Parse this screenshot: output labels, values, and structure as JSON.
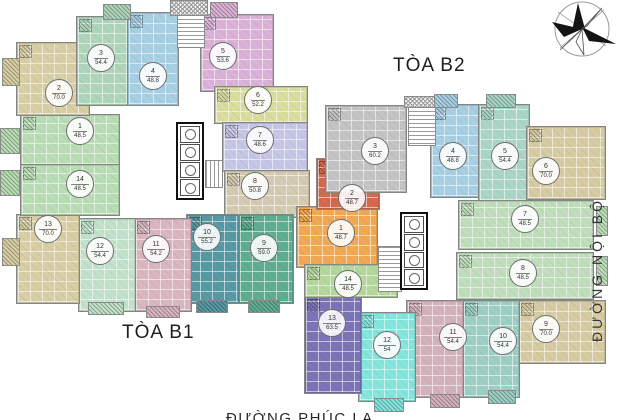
{
  "labels": {
    "tower_b1": "TÒA B1",
    "tower_b2": "TÒA B2",
    "road_right": "ĐƯỜNG NỘI BỘ",
    "road_bottom": "ĐƯỜNG PHÚC LA"
  },
  "towers": [
    {
      "id": "B1",
      "units": [
        {
          "no": "1",
          "area": "48.5",
          "color": "#b9ddb4",
          "x": 20,
          "y": 114,
          "w": 98,
          "h": 50,
          "lx": 79,
          "ly": 130
        },
        {
          "no": "2",
          "area": "70.0",
          "color": "#d9cfa4",
          "x": 16,
          "y": 42,
          "w": 72,
          "h": 72,
          "lx": 58,
          "ly": 92
        },
        {
          "no": "3",
          "area": "54.4",
          "color": "#afd6ba",
          "x": 76,
          "y": 16,
          "w": 52,
          "h": 88,
          "lx": 100,
          "ly": 57
        },
        {
          "no": "4",
          "area": "48.8",
          "color": "#a8d0e4",
          "x": 127,
          "y": 12,
          "w": 50,
          "h": 92,
          "lx": 152,
          "ly": 75
        },
        {
          "no": "5",
          "area": "53.6",
          "color": "#dcb2d8",
          "x": 200,
          "y": 14,
          "w": 72,
          "h": 76,
          "lx": 222,
          "ly": 55
        },
        {
          "no": "6",
          "area": "52.2",
          "color": "#d9dd9e",
          "x": 214,
          "y": 86,
          "w": 92,
          "h": 36,
          "lx": 257,
          "ly": 99
        },
        {
          "no": "7",
          "area": "48.6",
          "color": "#c6c6e6",
          "x": 222,
          "y": 122,
          "w": 84,
          "h": 48,
          "lx": 259,
          "ly": 139
        },
        {
          "no": "8",
          "area": "50.8",
          "color": "#d5cbb2",
          "x": 224,
          "y": 170,
          "w": 84,
          "h": 46,
          "lx": 254,
          "ly": 185
        },
        {
          "no": "9",
          "area": "59.0",
          "color": "#5fae91",
          "x": 238,
          "y": 214,
          "w": 54,
          "h": 88,
          "lx": 263,
          "ly": 247
        },
        {
          "no": "10",
          "area": "55.2",
          "color": "#569aa4",
          "x": 186,
          "y": 214,
          "w": 52,
          "h": 88,
          "lx": 206,
          "ly": 236
        },
        {
          "no": "11",
          "area": "54.2",
          "color": "#d9b6c0",
          "x": 134,
          "y": 218,
          "w": 56,
          "h": 92,
          "lx": 155,
          "ly": 248
        },
        {
          "no": "12",
          "area": "54.4",
          "color": "#c3e2cb",
          "x": 78,
          "y": 218,
          "w": 56,
          "h": 92,
          "lx": 99,
          "ly": 250
        },
        {
          "no": "13",
          "area": "70.0",
          "color": "#d9cfa4",
          "x": 16,
          "y": 214,
          "w": 62,
          "h": 88,
          "lx": 47,
          "ly": 228
        },
        {
          "no": "14",
          "area": "48.5",
          "color": "#b9ddb4",
          "x": 20,
          "y": 164,
          "w": 98,
          "h": 50,
          "lx": 79,
          "ly": 183
        }
      ]
    },
    {
      "id": "B2",
      "units": [
        {
          "no": "1",
          "area": "48.7",
          "color": "#f2a953",
          "x": 296,
          "y": 206,
          "w": 80,
          "h": 60,
          "lx": 340,
          "ly": 232
        },
        {
          "no": "2",
          "area": "48.7",
          "color": "#d4694e",
          "x": 316,
          "y": 158,
          "w": 62,
          "h": 50,
          "lx": 351,
          "ly": 197
        },
        {
          "no": "3",
          "area": "60.2",
          "color": "#c4c4c4",
          "x": 325,
          "y": 105,
          "w": 80,
          "h": 86,
          "lx": 374,
          "ly": 150
        },
        {
          "no": "4",
          "area": "48.8",
          "color": "#a8d0e4",
          "x": 430,
          "y": 104,
          "w": 50,
          "h": 92,
          "lx": 452,
          "ly": 155
        },
        {
          "no": "5",
          "area": "54.4",
          "color": "#abd6c6",
          "x": 478,
          "y": 104,
          "w": 50,
          "h": 96,
          "lx": 504,
          "ly": 155
        },
        {
          "no": "6",
          "area": "70.0",
          "color": "#d6cba2",
          "x": 526,
          "y": 126,
          "w": 78,
          "h": 72,
          "lx": 545,
          "ly": 170
        },
        {
          "no": "7",
          "area": "48.5",
          "color": "#c0debc",
          "x": 458,
          "y": 200,
          "w": 134,
          "h": 48,
          "lx": 524,
          "ly": 218
        },
        {
          "no": "8",
          "area": "48.5",
          "color": "#c0debc",
          "x": 456,
          "y": 252,
          "w": 136,
          "h": 46,
          "lx": 522,
          "ly": 272
        },
        {
          "no": "9",
          "area": "70.0",
          "color": "#d6cba2",
          "x": 518,
          "y": 300,
          "w": 86,
          "h": 62,
          "lx": 545,
          "ly": 328
        },
        {
          "no": "10",
          "area": "54.4",
          "color": "#9ecfc4",
          "x": 462,
          "y": 300,
          "w": 56,
          "h": 96,
          "lx": 502,
          "ly": 340
        },
        {
          "no": "11",
          "area": "54.4",
          "color": "#d4b2bc",
          "x": 406,
          "y": 300,
          "w": 56,
          "h": 96,
          "lx": 452,
          "ly": 336
        },
        {
          "no": "12",
          "area": "54",
          "color": "#85e6de",
          "x": 358,
          "y": 312,
          "w": 56,
          "h": 88,
          "lx": 386,
          "ly": 344
        },
        {
          "no": "13",
          "area": "63.5",
          "color": "#7b75b8",
          "x": 304,
          "y": 296,
          "w": 56,
          "h": 96,
          "lx": 331,
          "ly": 322
        },
        {
          "no": "14",
          "area": "48.5",
          "color": "#b4d89c",
          "x": 304,
          "y": 264,
          "w": 92,
          "h": 32,
          "lx": 347,
          "ly": 283
        }
      ]
    }
  ],
  "features": [
    {
      "name": "core-b1",
      "type": "core",
      "x": 176,
      "y": 122,
      "w": 28,
      "h": 78,
      "cells": 4
    },
    {
      "name": "core-b2",
      "type": "core",
      "x": 400,
      "y": 212,
      "w": 28,
      "h": 78,
      "cells": 4
    },
    {
      "name": "stairs-b1-top",
      "type": "stairs-v",
      "x": 177,
      "y": 14,
      "w": 26,
      "h": 32
    },
    {
      "name": "hatch-b1-top",
      "type": "hatch",
      "x": 170,
      "y": 0,
      "w": 36,
      "h": 14
    },
    {
      "name": "stairs-b1-mid",
      "type": "stairs-h",
      "x": 205,
      "y": 160,
      "w": 16,
      "h": 26
    },
    {
      "name": "stairs-b2-top",
      "type": "stairs-v",
      "x": 408,
      "y": 106,
      "w": 26,
      "h": 38
    },
    {
      "name": "hatch-b2-top",
      "type": "hatch",
      "x": 404,
      "y": 96,
      "w": 32,
      "h": 10
    },
    {
      "name": "stairs-b2-mid",
      "type": "stairs-v",
      "x": 378,
      "y": 246,
      "w": 22,
      "h": 44
    }
  ],
  "balconies": [
    {
      "x": 2,
      "y": 58,
      "w": 16,
      "h": 26,
      "color": "#d9cfa4"
    },
    {
      "x": 0,
      "y": 128,
      "w": 18,
      "h": 24,
      "color": "#b9ddb4"
    },
    {
      "x": 0,
      "y": 170,
      "w": 18,
      "h": 24,
      "color": "#b9ddb4"
    },
    {
      "x": 2,
      "y": 238,
      "w": 16,
      "h": 26,
      "color": "#d9cfa4"
    },
    {
      "x": 103,
      "y": 4,
      "w": 26,
      "h": 14,
      "color": "#afd6ba"
    },
    {
      "x": 210,
      "y": 2,
      "w": 26,
      "h": 14,
      "color": "#dcb2d8"
    },
    {
      "x": 88,
      "y": 302,
      "w": 34,
      "h": 11,
      "color": "#c3e2cb"
    },
    {
      "x": 146,
      "y": 306,
      "w": 32,
      "h": 10,
      "color": "#d9b6c0"
    },
    {
      "x": 196,
      "y": 300,
      "w": 30,
      "h": 11,
      "color": "#569aa4"
    },
    {
      "x": 248,
      "y": 300,
      "w": 30,
      "h": 11,
      "color": "#5fae91"
    },
    {
      "x": 434,
      "y": 94,
      "w": 22,
      "h": 12,
      "color": "#a8d0e4"
    },
    {
      "x": 486,
      "y": 94,
      "w": 28,
      "h": 12,
      "color": "#abd6c6"
    },
    {
      "x": 596,
      "y": 206,
      "w": 10,
      "h": 28,
      "color": "#c0debc"
    },
    {
      "x": 596,
      "y": 256,
      "w": 10,
      "h": 28,
      "color": "#c0debc"
    },
    {
      "x": 374,
      "y": 398,
      "w": 28,
      "h": 12,
      "color": "#85e6de"
    },
    {
      "x": 430,
      "y": 394,
      "w": 28,
      "h": 12,
      "color": "#d4b2bc"
    },
    {
      "x": 488,
      "y": 390,
      "w": 26,
      "h": 12,
      "color": "#9ecfc4"
    }
  ],
  "compass": {
    "icon": "compass-rose"
  }
}
